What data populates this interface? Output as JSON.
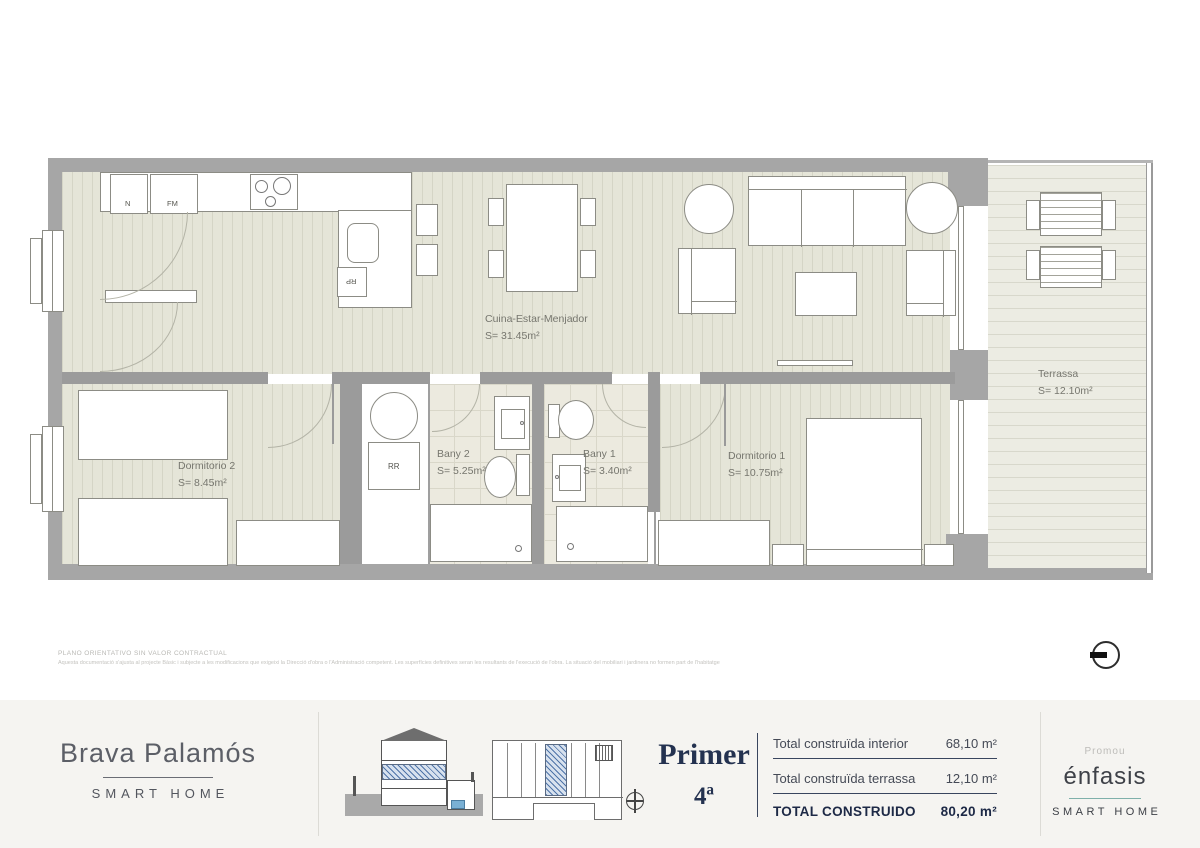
{
  "title": "Brava Palamós — Primer 4ª",
  "plan": {
    "rooms": [
      {
        "name": "Cuina-Estar-Menjador",
        "area": "S= 31.45m²"
      },
      {
        "name": "Terrassa",
        "area": "S= 12.10m²"
      },
      {
        "name": "Dormitorio 2",
        "area": "S= 8.45m²"
      },
      {
        "name": "Bany 2",
        "area": "S= 5.25m²"
      },
      {
        "name": "Bany 1",
        "area": "S= 3.40m²"
      },
      {
        "name": "Dormitorio 1",
        "area": "S= 10.75m²"
      }
    ],
    "tags": {
      "n": "N",
      "fm": "FM",
      "rp": "RP",
      "rr": "RR"
    }
  },
  "disclaimer": {
    "line1": "PLANO ORIENTATIVO SIN VALOR CONTRACTUAL",
    "line2": "Aquesta documentació s'ajusta al projecte Bàsic i subjecte a les modificacions que exigeixi la Direcció d'obra o l'Administració competent. Les superfícies definitives seran les resultants de l'execució de l'obra. La situació del mobiliari i jardinera no formen part de l'habitatge"
  },
  "footer": {
    "brand": {
      "name": "Brava Palamós",
      "tagline": "SMART HOME"
    },
    "unit": {
      "floor": "Primer",
      "door": "4ª"
    },
    "totals": {
      "rows": [
        {
          "label": "Total construïda interior",
          "value": "68,10 m²"
        },
        {
          "label": "Total construïda terrassa",
          "value": "12,10 m²"
        }
      ],
      "total": {
        "label": "TOTAL CONSTRUIDO",
        "value": "80,20 m²"
      }
    },
    "promoter": {
      "label": "Promou",
      "name": "énfasis",
      "tagline": "SMART HOME"
    }
  },
  "colors": {
    "navy": "#243250",
    "teal": "#7fb0aa",
    "wall_gray": "#a6a6a6",
    "floor": "#e5e5d8",
    "hatch_blue": "#4f74a8"
  }
}
